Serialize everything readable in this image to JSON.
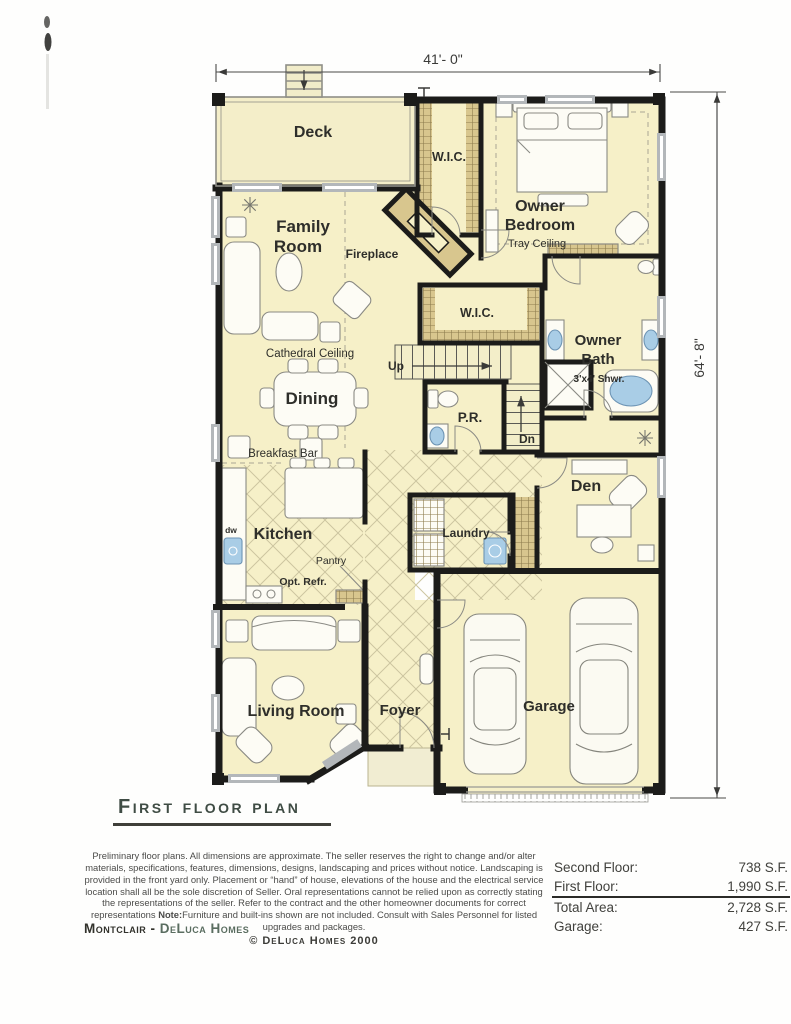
{
  "page": {
    "title": "First floor plan",
    "copyright": "© DeLuca Homes 2000",
    "brand": {
      "model": "Montclair",
      "separator": " - ",
      "builder": "DeLuca Homes"
    },
    "disclaimer": {
      "p1": "Preliminary floor plans. All dimensions are approximate. The seller reserves the right to change and/or alter materials, specifications, features, dimensions, designs, landscaping and prices without notice. Landscaping is provided in the front yard only.  Placement or “hand” of house, elevations of the house and the electrical service location shall all be the sole discretion of Seller.  Oral representations cannot be relied upon as correctly stating the representations of the seller. Refer to the contract and the other homeowner documents for correct representations  ",
      "note_label": "Note:",
      "p2": "Furniture and built-ins shown are not included. Consult with Sales Personnel for listed upgrades and packages."
    }
  },
  "dimensions": {
    "width_label": "41'- 0\"",
    "height_label": "64'- 8\""
  },
  "plan_labels": {
    "deck": "Deck",
    "family_line1": "Family",
    "family_line2": "Room",
    "fireplace": "Fireplace",
    "wic": "W.I.C.",
    "owner_bedroom_line1": "Owner",
    "owner_bedroom_line2": "Bedroom",
    "tray_ceiling": "Tray Ceiling",
    "cathedral_ceiling": "Cathedral Ceiling",
    "owner_bath_line1": "Owner",
    "owner_bath_line2": "Bath",
    "shower": "3'x4' Shwr.",
    "dining": "Dining",
    "powder_room": "P.R.",
    "up": "Up",
    "down": "Dn",
    "breakfast_bar": "Breakfast Bar",
    "kitchen": "Kitchen",
    "pantry": "Pantry",
    "opt_refrigerator": "Opt. Refr.",
    "dishwasher": "dw",
    "laundry": "Laundry",
    "den": "Den",
    "living_room": "Living Room",
    "foyer": "Foyer",
    "garage": "Garage"
  },
  "areas": {
    "rows": [
      {
        "label": "Second Floor:",
        "value": "738 S.F."
      },
      {
        "label": "First Floor:",
        "value": "1,990 S.F."
      },
      {
        "label": "Total Area:",
        "value": "2,728 S.F."
      },
      {
        "label": "Garage:",
        "value": "427 S.F."
      }
    ]
  },
  "colors": {
    "floor": "#f6f0c8",
    "wall": "#1c1c1a",
    "shelf_tan": "#d8c68e",
    "fixture_blue": "#a9cde6",
    "title_green": "#3f4c44",
    "brand_green": "#5a6d60"
  }
}
